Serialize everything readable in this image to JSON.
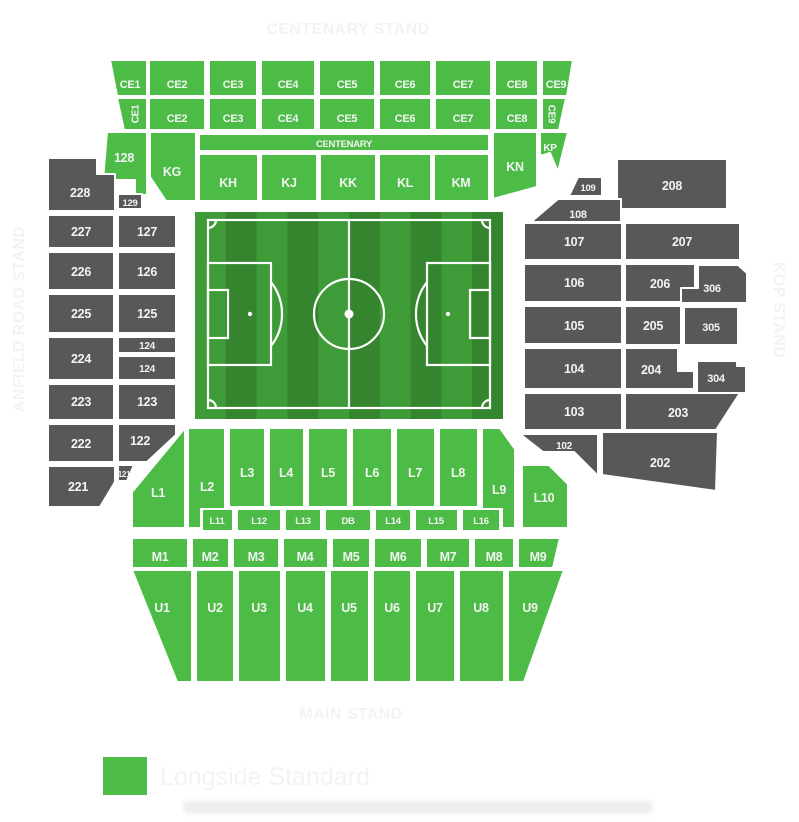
{
  "stand_labels": {
    "top": "CENTENARY STAND",
    "bottom": "MAIN STAND",
    "left": "ANFIELD ROAD STAND",
    "right": "KOP STAND"
  },
  "banner": {
    "centenary": "CENTENARY"
  },
  "colors": {
    "available": "#4CBC47",
    "unavailable": "#58585A",
    "stand_label": "#23798B",
    "section_label": "#F2F4F1",
    "pitch_light": "#3F9A38",
    "pitch_dark": "#35852F",
    "pitch_line": "#FFFFFF",
    "legend_text": "#1D1D1D"
  },
  "legend": {
    "items": [
      {
        "label": "Longside Standard",
        "color": "#4CBC47"
      }
    ]
  },
  "sections": {
    "ce_row1": [
      "CE1",
      "CE2",
      "CE3",
      "CE4",
      "CE5",
      "CE6",
      "CE7",
      "CE8",
      "CE9"
    ],
    "ce_row2": [
      "CE1",
      "CE2",
      "CE3",
      "CE4",
      "CE5",
      "CE6",
      "CE7",
      "CE8",
      "CE9"
    ],
    "k_row": [
      "128",
      "KG",
      "KH",
      "KJ",
      "KK",
      "KL",
      "KM",
      "KN",
      "KP"
    ],
    "anfield_outer": [
      "228",
      "227",
      "226",
      "225",
      "224",
      "223",
      "222",
      "221"
    ],
    "anfield_inner": [
      "129",
      "127",
      "126",
      "125",
      "124",
      "124",
      "123",
      "122",
      "121"
    ],
    "kop_100": [
      "109",
      "108",
      "107",
      "106",
      "105",
      "104",
      "103",
      "102"
    ],
    "kop_200": [
      "208",
      "207",
      "206",
      "205",
      "204",
      "203",
      "202"
    ],
    "kop_300": [
      "306",
      "305",
      "304"
    ],
    "l_row": [
      "L1",
      "L2",
      "L3",
      "L4",
      "L5",
      "L6",
      "L7",
      "L8",
      "L9",
      "L10"
    ],
    "l_sub": [
      "L11",
      "L12",
      "L13",
      "DB",
      "L14",
      "L15",
      "L16"
    ],
    "m_row": [
      "M1",
      "M2",
      "M3",
      "M4",
      "M5",
      "M6",
      "M7",
      "M8",
      "M9"
    ],
    "u_row": [
      "U1",
      "U2",
      "U3",
      "U4",
      "U5",
      "U6",
      "U7",
      "U8",
      "U9"
    ]
  }
}
